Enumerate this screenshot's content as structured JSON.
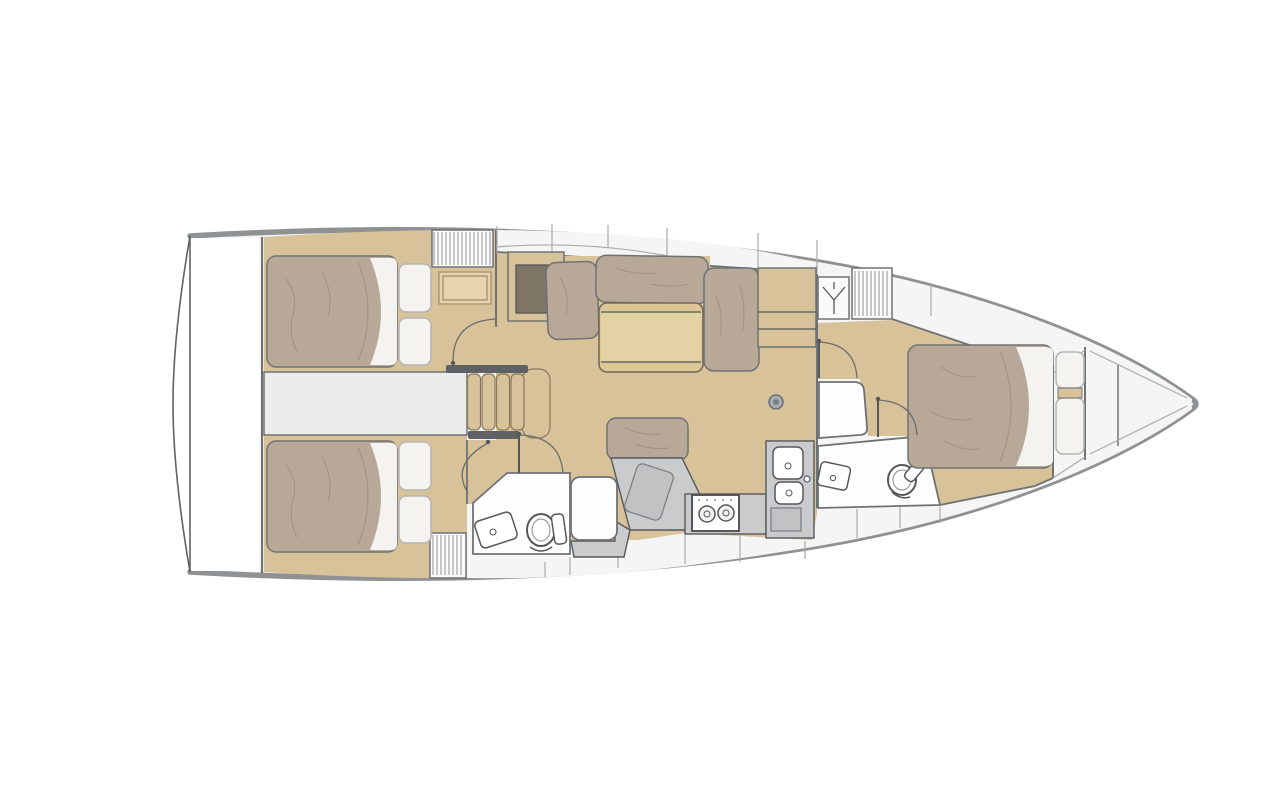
{
  "title": "Sailboat interior layout floor plan, top view, bow to the right",
  "palette": {
    "background": "#ffffff",
    "hull_outline": "#8f9294",
    "stern_outline": "#606365",
    "deck_white": "#f5f5f6",
    "room_white": "#fdfdfd",
    "corridor_gray": "#ebebec",
    "interior_line": "#6f7274",
    "furniture_line": "#55585a",
    "seam_line": "#a8abad",
    "floor_wood": "#d8c29a",
    "floor_wood_light": "#e6d4af",
    "table_wood": "#ddc795",
    "table_leaf": "#e3d2a4",
    "cabinet_inset": "#7e7567",
    "mattress_taupe": "#b7a898",
    "mattress_line": "#a09181",
    "pillow_white": "#f4f3f0",
    "pillow_line": "#b5b5b2",
    "counter_gray": "#c9cbcd",
    "counter_gray_dark": "#c0c2c4",
    "stair_rail": "#5f6264",
    "door_arc": "#6b6e70"
  },
  "areas": {
    "stern_platform": {
      "label": "transom platform"
    },
    "aft_cabin_port": {
      "label": "aft cabin port",
      "fixtures": [
        "double-berth",
        "pillows",
        "louvered-locker",
        "vanity-shelf"
      ]
    },
    "aft_cabin_starboard": {
      "label": "aft cabin starboard",
      "fixtures": [
        "double-berth",
        "pillows",
        "louvered-locker"
      ]
    },
    "companionway": {
      "label": "companionway",
      "fixtures": [
        "stairs-4-steps",
        "landing"
      ]
    },
    "saloon": {
      "label": "saloon",
      "fixtures": [
        "l-settee",
        "folding-table",
        "bench-seat",
        "sideboard",
        "mast-post"
      ]
    },
    "galley": {
      "label": "galley",
      "fixtures": [
        "two-burner-stove",
        "double-sink",
        "worktop",
        "cutting-board"
      ]
    },
    "aft_head": {
      "label": "aft head",
      "fixtures": [
        "toilet",
        "washbasin",
        "shower"
      ]
    },
    "forward_head": {
      "label": "forward head",
      "fixtures": [
        "toilet",
        "washbasin",
        "shower-seat"
      ]
    },
    "forward_cabin": {
      "label": "forward cabin",
      "fixtures": [
        "double-berth",
        "pillows",
        "hanging-locker",
        "louvered-locker",
        "cabinets"
      ]
    },
    "bow_locker": {
      "label": "anchor locker"
    }
  }
}
